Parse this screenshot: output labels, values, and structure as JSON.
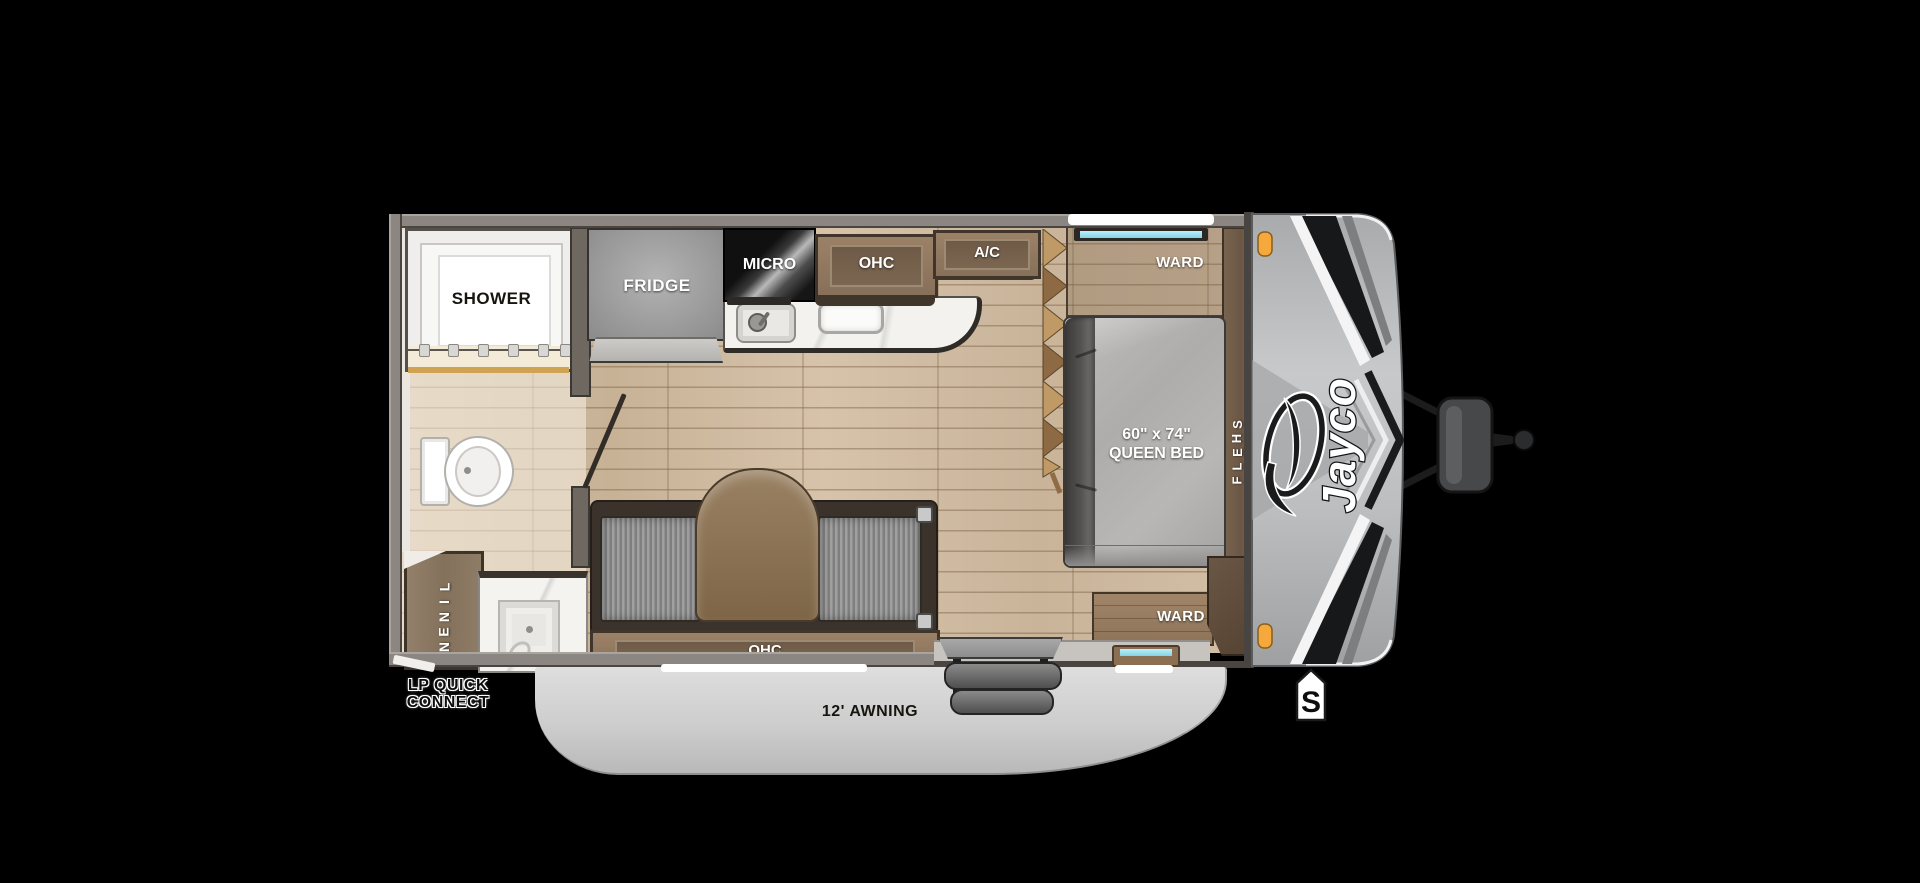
{
  "brand": "Jayco",
  "rooms": {
    "bathroom": {
      "shower": "SHOWER",
      "linen": "LINEN"
    },
    "kitchen": {
      "fridge": "FRIDGE",
      "microwave": "MICRO",
      "overhead_cabinet": "OHC",
      "air_conditioner": "A/C"
    },
    "dinette": {
      "overhead_cabinet": "OHC"
    },
    "bedroom": {
      "bed_size": "60\" x 74\"",
      "bed_type": "QUEEN BED",
      "wardrobe_front": "WARD",
      "wardrobe_entry_side": "WARD",
      "shelf": "SHELF"
    }
  },
  "exterior": {
    "awning": "12' AWNING",
    "lp_quick_connect_line1": "LP QUICK",
    "lp_quick_connect_line2": "CONNECT",
    "spare_tire_marker": "S"
  },
  "colors": {
    "background": "#000000",
    "wall": "#8b8682",
    "floor_wood": "#cdb9a0",
    "bathroom_floor": "#e8dcc6",
    "cabinet_wood": "#8a7660",
    "dark_trim": "#3f352a",
    "counter_white": "#f3f2ee",
    "fridge_gray": "#9e9e9e",
    "micro_black": "#161616",
    "mattress_gray": "#aeadab",
    "cushion_gray": "#8f8f8f",
    "table_wood": "#8a7156",
    "awning_gray": "#d3d3d3",
    "front_cap_gray": "#b9bbbb",
    "graphics_dark": "#1a1b1d",
    "marker_orange": "#f5a93c",
    "window_blue": "#8fd8ec",
    "steps_gray": "#5e5e5e"
  }
}
